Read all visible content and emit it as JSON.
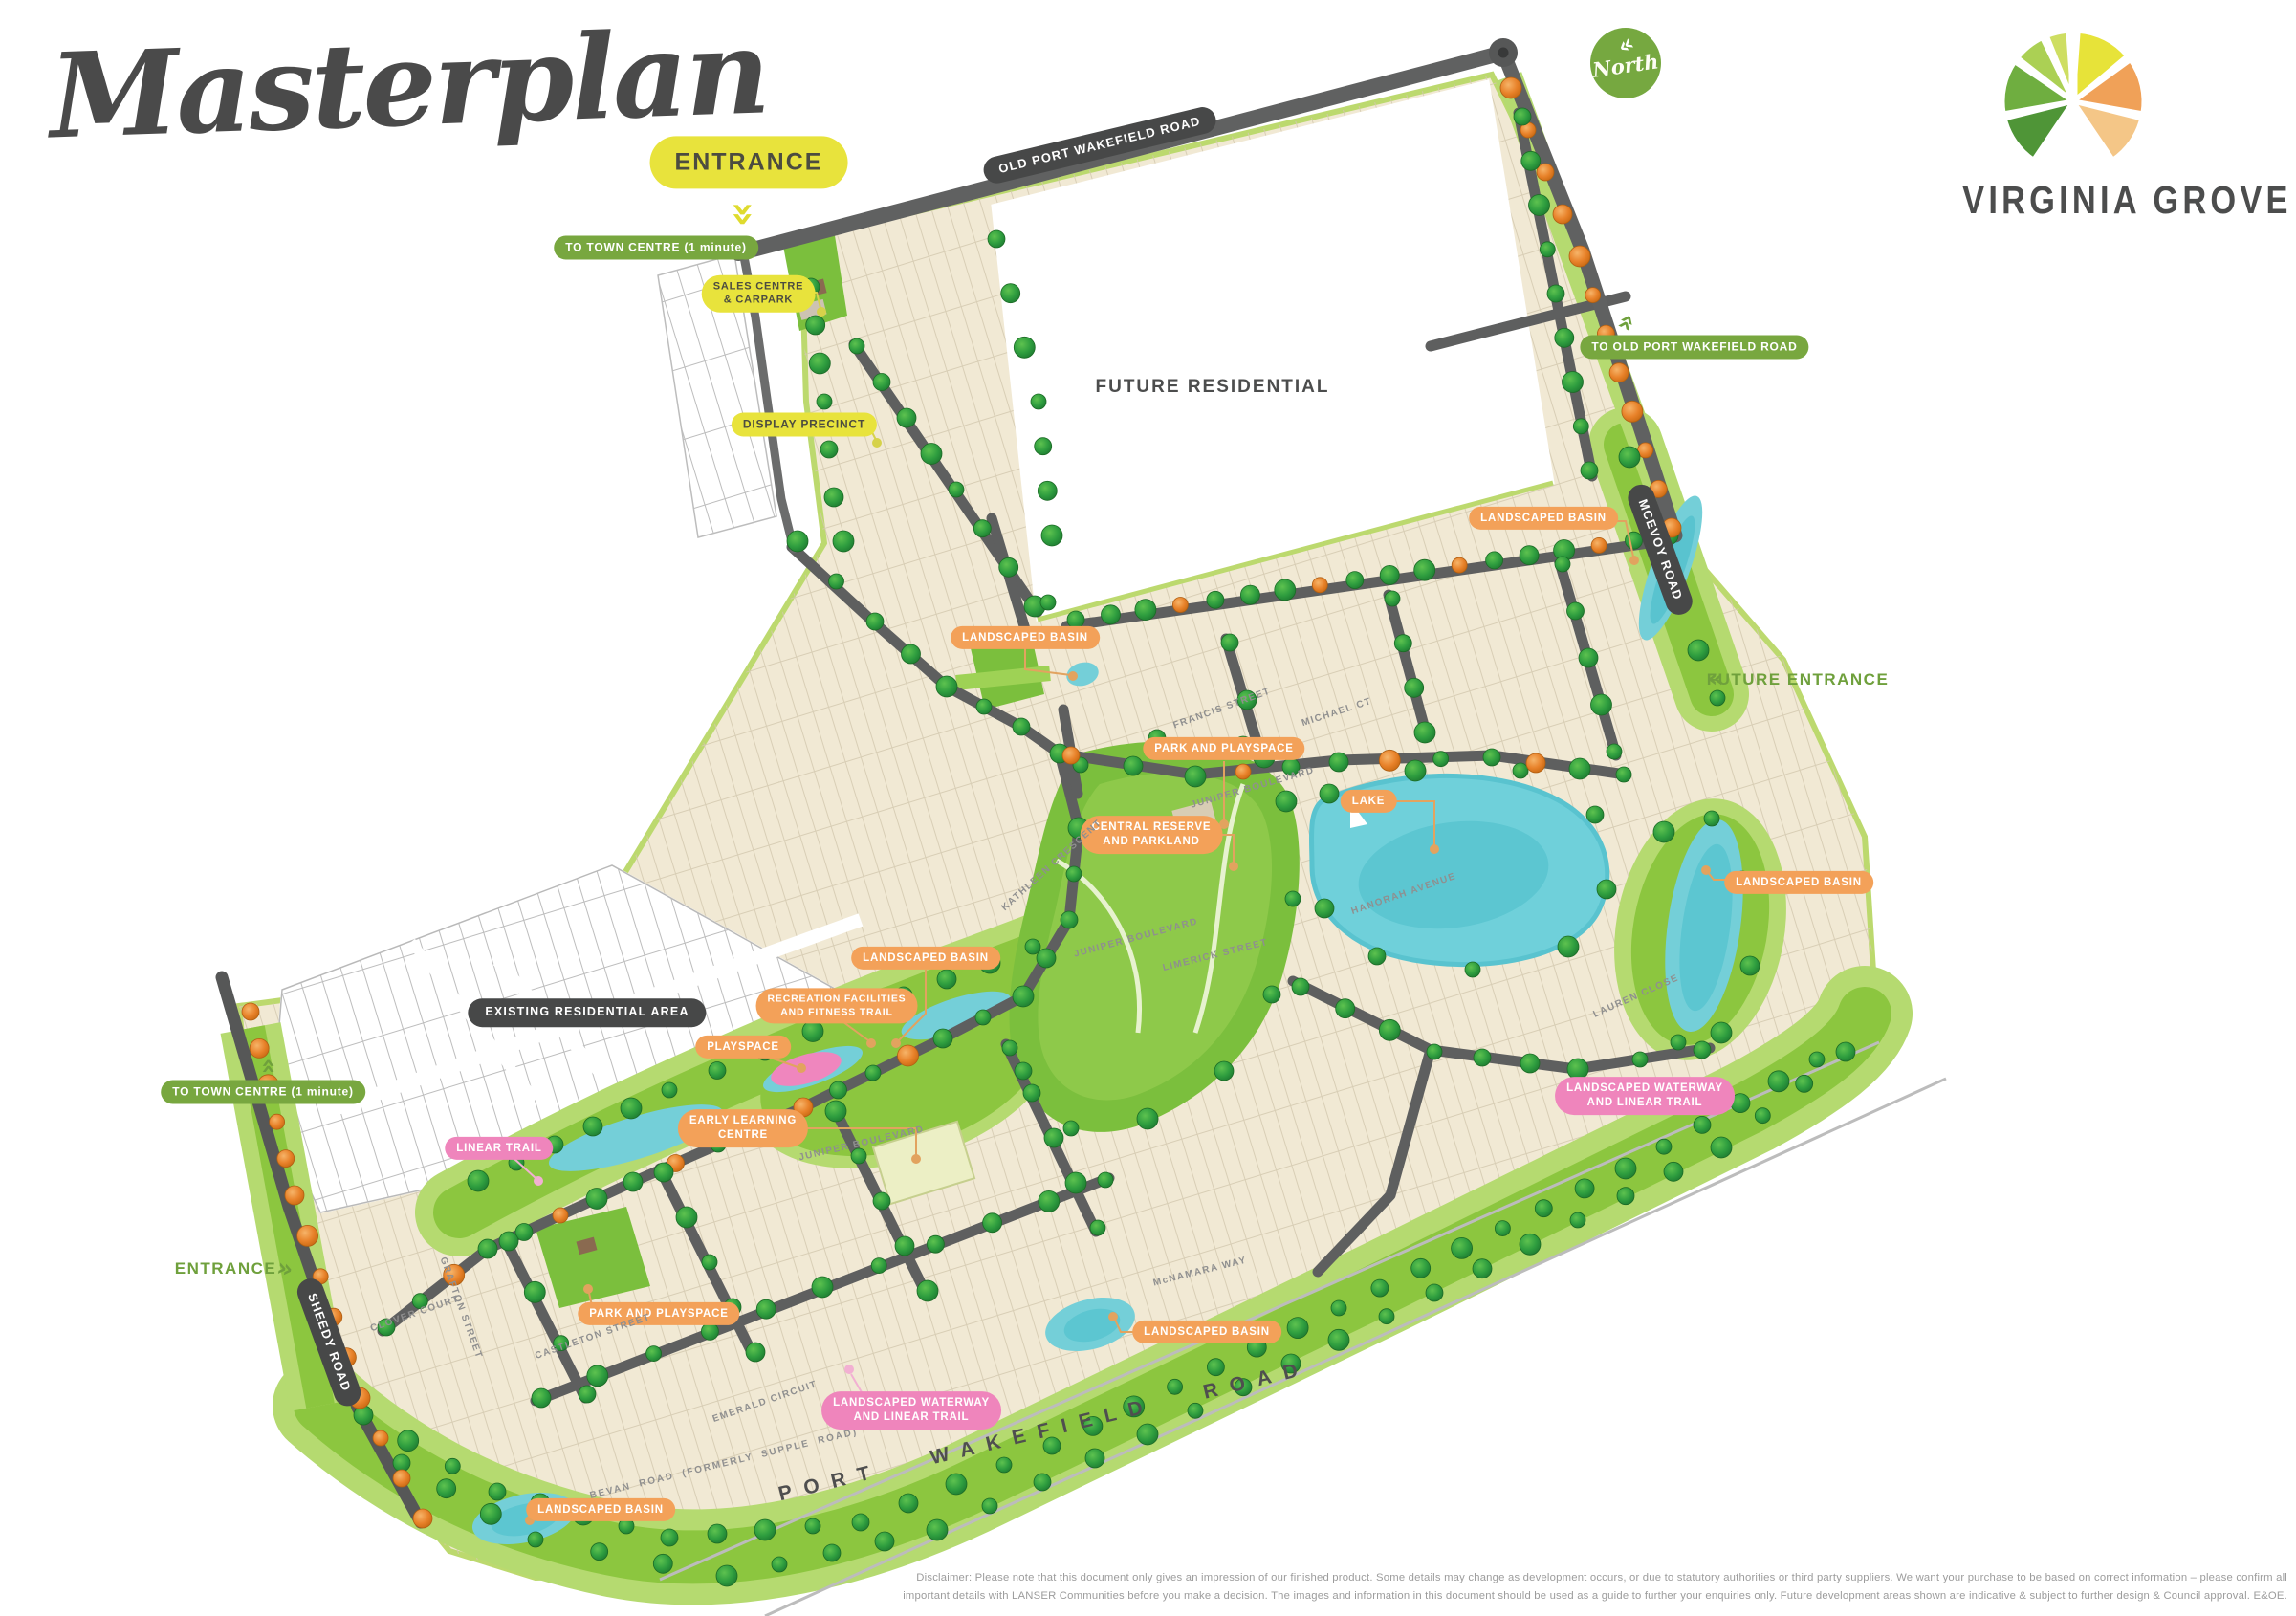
{
  "title": "Masterplan",
  "brand": {
    "name": "VIRGINIA GROVE"
  },
  "north": {
    "label": "North"
  },
  "icons": {
    "chevron_left": "«",
    "chevron_right": "»"
  },
  "areas": {
    "future_residential": "FUTURE RESIDENTIAL",
    "existing_residential": "EXISTING RESIDENTIAL AREA"
  },
  "roads": {
    "old_port_wakefield": "OLD PORT WAKEFIELD ROAD",
    "mcevoy": "MCEVOY ROAD",
    "sheedy": "SHEEDY ROAD",
    "port_wakefield": "PORT WAKEFIELD ROAD",
    "bevan": "BEVAN ROAD (FORMERLY SUPPLE ROAD)"
  },
  "callouts": {
    "entrance": "ENTRANCE",
    "to_town_centre": "TO TOWN CENTRE (1 minute)",
    "sales_centre_l1": "SALES CENTRE",
    "sales_centre_l2": "& CARPARK",
    "display_precinct": "DISPLAY PRECINCT",
    "to_old_port_wakefield": "TO OLD PORT WAKEFIELD ROAD",
    "future_entrance": "FUTURE ENTRANCE",
    "landscaped_basin": "LANDSCAPED BASIN",
    "park_and_playspace": "PARK AND PLAYSPACE",
    "lake": "LAKE",
    "central_reserve_l1": "CENTRAL RESERVE",
    "central_reserve_l2": "AND PARKLAND",
    "recreation_l1": "RECREATION FACILITIES",
    "recreation_l2": "AND FITNESS TRAIL",
    "playspace": "PLAYSPACE",
    "early_learning_l1": "EARLY LEARNING",
    "early_learning_l2": "CENTRE",
    "linear_trail": "LINEAR TRAIL",
    "waterway_l1": "LANDSCAPED WATERWAY",
    "waterway_l2": "AND LINEAR TRAIL"
  },
  "streets": {
    "francis": "FRANCIS STREET",
    "michael": "MICHAEL CT",
    "juniper": "JUNIPER BOULEVARD",
    "kathleen": "KATHLEEN CRESCENT",
    "limerick": "LIMERICK STREET",
    "hanorah": "HANORAH AVENUE",
    "castleton": "CASTLETON STREET",
    "emerald": "EMERALD CIRCUIT",
    "lauren": "LAUREN CLOSE",
    "clover": "CLOVER COURT",
    "grafton": "GRAFTON STREET",
    "mcnamara": "McNAMARA WAY"
  },
  "disclaimer": {
    "line1": "Disclaimer: Please note that this document only gives an impression of our finished product.  Some details may change as development occurs, or due to statutory authorities or third party suppliers.  We want your purchase to be based on correct information – please confirm all",
    "line2": "important details with LANSER Communities before you make a decision. The images and information in this document should be used as a guide to further your enquiries only. Future development areas shown are indicative & subject to further design & Council approval. E&OE."
  },
  "colors": {
    "badge_orange": "#f3a159",
    "badge_pink": "#ef85bc",
    "badge_green": "#78a73f",
    "badge_dark": "#474848",
    "badge_yellow": "#e8e33c",
    "estate_cream": "#f1e9d4",
    "park_green": "#7bbf3d",
    "band_green": "#8cc63f",
    "band_light": "#b5da70",
    "water_teal": "#74cfd8",
    "road_grey": "#5e5f5f",
    "tree_green": "#2f9e3f",
    "tree_orange": "#e8822a"
  }
}
